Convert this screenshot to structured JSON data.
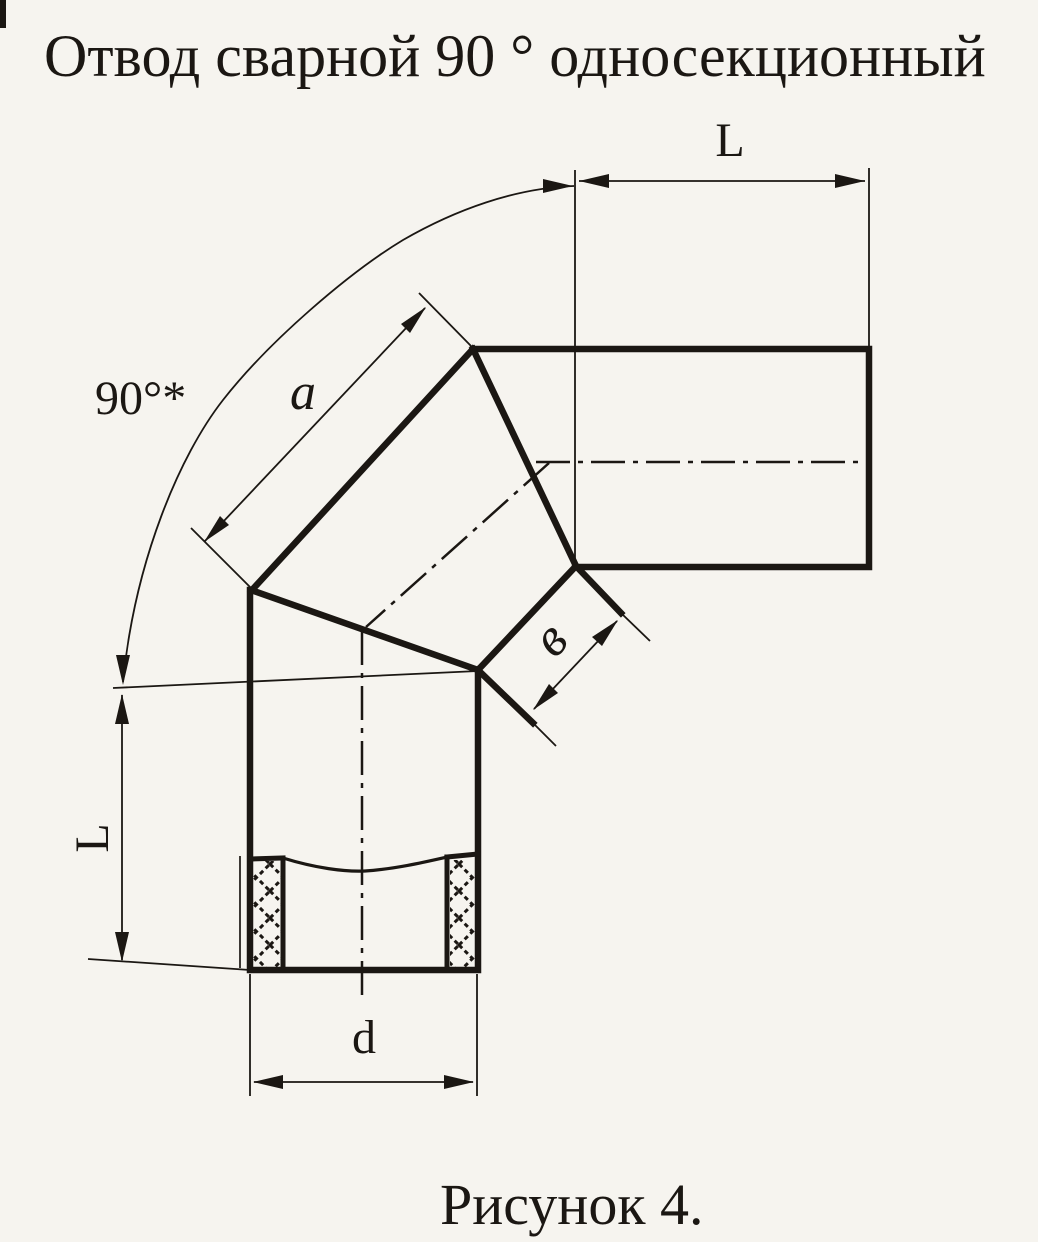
{
  "title": "Отвод сварной 90 ° односекционный",
  "caption": "Рисунок 4.",
  "labels": {
    "length_top": "L",
    "length_left": "L",
    "angle": "90°*",
    "section_outer_width": "a",
    "section_inner_width": "в",
    "diameter": "d"
  },
  "colors": {
    "ink": "#1b1713",
    "paper": "#f6f4ef"
  }
}
